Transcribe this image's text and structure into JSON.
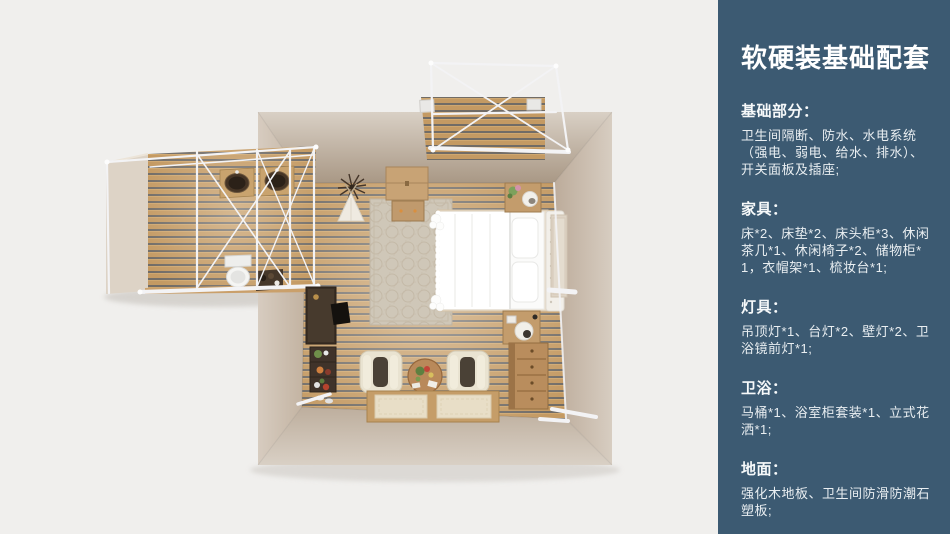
{
  "panel": {
    "title": "软硬装基础配套",
    "sections": [
      {
        "heading": "基础部分：",
        "body": "卫生间隔断、防水、水电系统（强电、弱电、给水、排水）、开关面板及插座;"
      },
      {
        "heading": "家具：",
        "body": "床*2、床垫*2、床头柜*3、休闲茶几*1、休闲椅子*2、储物柜*1，衣帽架*1、梳妆台*1;"
      },
      {
        "heading": "灯具：",
        "body": "吊顶灯*1、台灯*2、壁灯*2、卫浴镜前灯*1;"
      },
      {
        "heading": "卫浴：",
        "body": "马桶*1、浴室柜套装*1、立式花洒*1;"
      },
      {
        "heading": "地面：",
        "body": "强化木地板、卫生间防滑防潮石塑板;"
      }
    ]
  },
  "floorplan": {
    "view": "top-down-3d-render",
    "items": [
      "main-room",
      "bathroom-extension",
      "porch-extension",
      "double-bed",
      "headboard",
      "pillows",
      "rug",
      "storage-chest",
      "coat-rack-teepee",
      "nightstand",
      "table-lamp",
      "dressing-desk",
      "plant-rack",
      "lounge-chair",
      "tea-table",
      "tatami-platform",
      "dresser",
      "twin-basins",
      "toilet",
      "side-table",
      "white-truss-frame"
    ]
  },
  "colors": {
    "page_bg": "#f0efed",
    "panel_bg": "#3c5a72",
    "panel_title": "#ffffff",
    "panel_text": "#e9eef1",
    "wall_light": "#d8cec2",
    "wall_dark": "#ab9a89",
    "floor_wood": "#c49a63",
    "floor_gap": "#5d6066",
    "frame_white": "#f3f3f5",
    "bed_white": "#fbfbfa"
  }
}
